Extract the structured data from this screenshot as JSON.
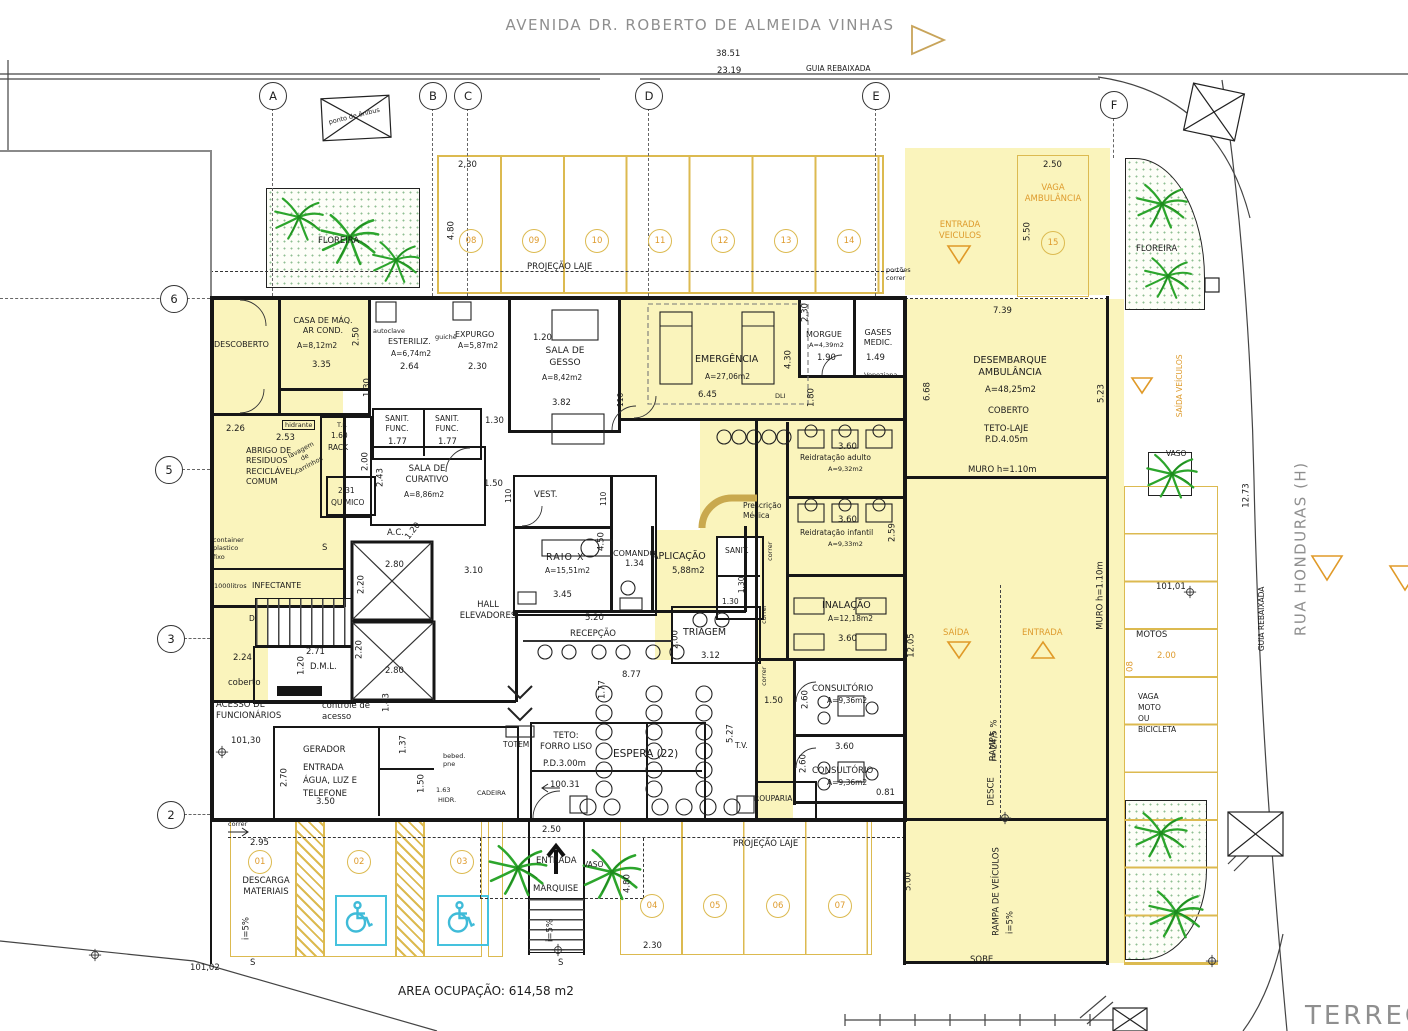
{
  "streets": {
    "avenue": "AVENIDA DR. ROBERTO DE ALMEIDA VINHAS",
    "avenue_dim": "38.51",
    "avenue_dim2": "23.19",
    "guia_top": "GUIA REBAIXADA",
    "bus_stop": "ponto de ônibus",
    "side": "RUA HONDURAS (H)",
    "guia_side": "GUIA REBAIXADA",
    "side_dim": "12.73"
  },
  "grid": {
    "cols": [
      "A",
      "B",
      "C",
      "D",
      "E",
      "F"
    ],
    "rows": [
      "6",
      "5",
      "3",
      "2"
    ]
  },
  "parking": {
    "top_numbers": [
      "08",
      "09",
      "10",
      "11",
      "12",
      "13",
      "14"
    ],
    "left_numbers": [
      "01",
      "02",
      "03"
    ],
    "bottom_numbers": [
      "04",
      "05",
      "06",
      "07"
    ],
    "amb_number": "15",
    "top_w": "2,30",
    "top_h": "4.80",
    "proj_top": "PROJEÇÃO LAJE",
    "portoes": "portões\ncorrer",
    "bottom_w": "2.30",
    "bottom_h": "4.80",
    "proj_bottom": "PROJEÇÃO LAJE",
    "motos": "MOTOS",
    "motos_dim": "2.00",
    "motos_num": "08",
    "vaga_moto": "VAGA\nMOTO\nOU\nBICICLETA",
    "ref_101_01": "101,01",
    "descarga": "DESCARGA\nMATERIAIS",
    "d295": "2.95",
    "ref_101_02": "101,02",
    "correr": "correr"
  },
  "ambulance": {
    "entrada_veiculos": "ENTRADA\nVEICULOS",
    "vaga": "VAGA\nAMBULÂNCIA",
    "w": "2.50",
    "h": "5.50",
    "saida_veiculos": "SAÍDA VEÍCULOS"
  },
  "desembarque": {
    "name": "DESEMBARQUE\nAMBULÂNCIA",
    "area": "A=48,25m2",
    "coberto": "COBERTO",
    "teto": "TETO-LAJE",
    "pd": "P.D.4.05m",
    "d739": "7.39",
    "d668": "6.68",
    "d523": "5.23",
    "muro_h": "MURO  h=1.10m"
  },
  "ramp": {
    "saida": "SAÍDA",
    "entrada": "ENTRADA",
    "rampa": "RAMPA",
    "slope": "i= 24,5 %",
    "desce": "DESCE",
    "muro_v": "MURO  h=1.10m",
    "d1205": "12.05",
    "rampa_veic": "RAMPA DE VEÍCULOS",
    "slope2": "i=5%",
    "sobe": "SOBE",
    "d500": "5.00"
  },
  "planters": {
    "fl_tl": "FLOREIRA",
    "fl_tr": "FLOREIRA",
    "vaso_r": "VASO",
    "vaso_b": "VASO"
  },
  "rooms": {
    "descoberto": {
      "name": "DESCOBERTO",
      "d": "2.26"
    },
    "casa_maq": {
      "name": "CASA DE MÁQ.\nAR COND.",
      "area": "A=8,12m2",
      "w": "3.35",
      "h": "2.50"
    },
    "esteriliz": {
      "name": "ESTERILIZ.",
      "area": "A=6,74m2",
      "w": "2.64",
      "autoclave": "autoclave",
      "guiche": "guichê"
    },
    "expurgo": {
      "name": "EXPURGO",
      "area": "A=5,87m2",
      "w": "2.30"
    },
    "gesso": {
      "name": "SALA DE\nGESSO",
      "area": "A=8,42m2",
      "w": "3.82",
      "d120": "1.20"
    },
    "emergencia": {
      "name": "EMERGÊNCIA",
      "area": "A=27,06m2",
      "w": "6.45",
      "d430": "4.30",
      "d180": "1.80",
      "d110": "110",
      "dli": "DLI"
    },
    "morgue": {
      "name": "MORGUE",
      "area": "A=4,39m2",
      "w": "1.90",
      "h": "2.30"
    },
    "gases": {
      "name": "GASES\nMEDIC.",
      "w": "1.49",
      "veneziana": "Veneziana"
    },
    "hidrante": {
      "name": "hidrante",
      "d253": "2.53",
      "lavagem": "lavagem\nde\ncarrinhos",
      "d130": "1.30"
    },
    "rack": {
      "name": "RACK",
      "tf": "T.F.",
      "w": "1.60",
      "h": "2.00"
    },
    "sanit_func1": {
      "name": "SANIT.\nFUNC.",
      "w": "1.77"
    },
    "sanit_func2": {
      "name": "SANIT.\nFUNC.",
      "w": "1.77",
      "d130": "1.30"
    },
    "abrigo": {
      "name": "ABRIGO DE\nRESIDUOS\nRECICLÁVEL/\nCOMUM",
      "container": "container\nplastico\nfixo",
      "litros": "1000litros",
      "infectante": "INFECTANTE"
    },
    "quimico": {
      "name": "QUÍMICO",
      "d": "2.31"
    },
    "curativo": {
      "name": "SALA DE\nCURATIVO",
      "area": "A=8,86m2",
      "h": "2.43",
      "d150": "1.50",
      "d110": "110"
    },
    "ac": {
      "name": "A.C.",
      "d": "1.20"
    },
    "elevators": {
      "hall": "HALL\nELEVADORES",
      "d310": "3.10",
      "w1": "2.80",
      "h1": "2.20",
      "w2": "2.80",
      "h2": "2.20",
      "s": "S",
      "d": "D"
    },
    "dml": {
      "name": "D.M.L.",
      "w": "2.71",
      "h": "1.20"
    },
    "acesso": {
      "name": "ACESSO DE\nFUNCIONÁRIOS",
      "coberto": "coberto",
      "d224": "2.24",
      "ref": "101,30",
      "controle": "controle de\nacesso",
      "d143": "1.43"
    },
    "gerador": {
      "name": "GERADOR",
      "sub": "ENTRADA\nÁGUA, LUZ E\nTELEFONE",
      "w": "3.50",
      "h": "2.70"
    },
    "banheiros": {
      "d137": "1.37",
      "bebed": "bebed.\npne",
      "d150": "1.50",
      "hidr": "HIDR.",
      "d163": "1.63",
      "cadeira": "CADEIRA",
      "totem": "TOTEM"
    },
    "vest": {
      "name": "VEST."
    },
    "raiox": {
      "name": "RAIO  X",
      "area": "A=15,51m2",
      "w": "3.45",
      "h": "4.50",
      "d110": "110"
    },
    "comando": {
      "name": "COMANDO",
      "w": "1.34"
    },
    "aplicacao": {
      "name": "APLICAÇÃO",
      "area": "5,88m2"
    },
    "prescricao": {
      "name": "Prescrição\nMédica"
    },
    "sanit_c": {
      "name": "SANIT.",
      "d1": "1.30",
      "d2": "1.30"
    },
    "recepcao": {
      "name": "RECEPÇÃO",
      "w": "5.20"
    },
    "triagem": {
      "name": "TRIAGEM",
      "h": "2.00",
      "w": "3.12"
    },
    "espera": {
      "name": "ESPERA  (22)",
      "teto": "TETO:\nFORRO  LISO",
      "pd": "P.D.3.00m",
      "ref": "100.31",
      "d877": "8.77",
      "d177": "1.77",
      "d250": "2.50"
    },
    "tv": {
      "name": "T.V.",
      "d527": "5.27",
      "d150": "1.50"
    },
    "rouparia": {
      "name": "ROUPARIA"
    },
    "consult1": {
      "name": "CONSULTÓRIO",
      "area": "A=9,36m2",
      "h": "2.60"
    },
    "consult2": {
      "name": "CONSULTÓRIO",
      "area": "A=9,36m2",
      "h": "2.60",
      "w": "3.60",
      "d081": "0.81"
    },
    "reidrat_a": {
      "name": "Reidratação  adulto",
      "area": "A=9,32m2",
      "w": "3.60"
    },
    "reidrat_i": {
      "name": "Reidratação  infantil",
      "area": "A=9,33m2",
      "w": "3.60",
      "h": "2.59"
    },
    "inalacao": {
      "name": "INALAÇÃO",
      "area": "A=12,18m2",
      "w": "3.60"
    },
    "corr": {
      "c1": "correr",
      "c2": "correr",
      "c3": "correr"
    }
  },
  "entrance": {
    "marquise": "MARQUISE",
    "entrada": "ENTRADA",
    "w": "2.50",
    "slope": "i=5%",
    "s": "S",
    "slope_l": "i=5%",
    "s_l": "S"
  },
  "footer": {
    "area": "AREA  OCUPAÇÃO:  614,58  m2",
    "floor": "TERREO"
  }
}
